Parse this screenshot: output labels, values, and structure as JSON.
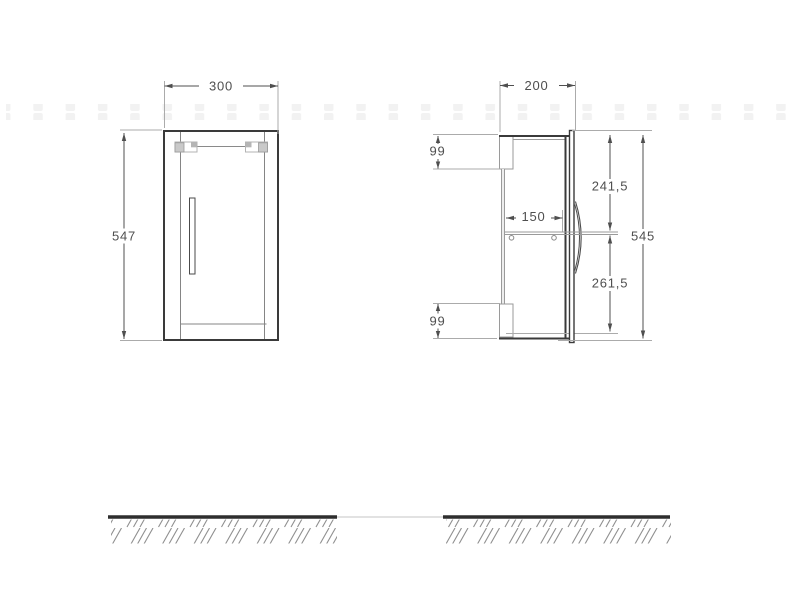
{
  "drawing": {
    "type": "cabinet-technical-drawing",
    "front": {
      "width_label": "300",
      "height_label": "547"
    },
    "side": {
      "depth_label": "200",
      "top_bracket_offset_label": "99",
      "bottom_bracket_offset_label": "99",
      "shelf_depth_label": "150",
      "top_to_shelf_label": "241,5",
      "shelf_to_bottom_label": "261,5",
      "height_label": "545"
    },
    "colors": {
      "outline": "#3a3a3a",
      "dimension_line": "#4f4f4f",
      "extension_line": "#ababab",
      "inner_line": "#8a8a8a",
      "ground": "#2e2e2e",
      "hatch": "#8f8f8f",
      "label_text": "#4f4f4f",
      "watermark": "#f2f2f2"
    }
  }
}
